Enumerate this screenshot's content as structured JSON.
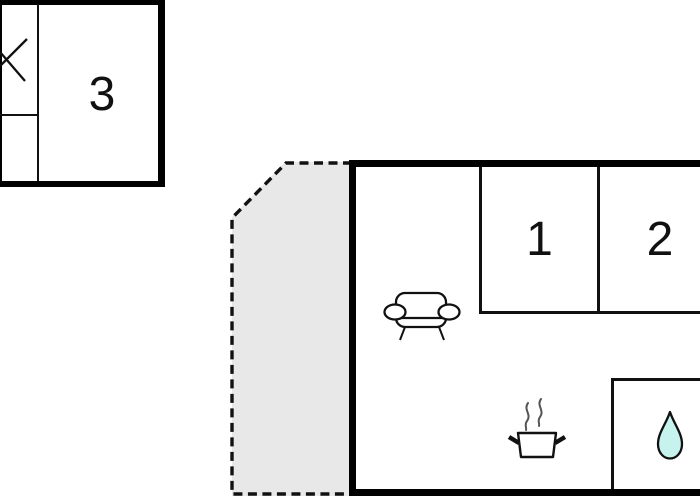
{
  "title": "Holiday home floor plan",
  "colors": {
    "background": "#ffffff",
    "wall": "#000000",
    "terrace_fill": "#e8e8e8",
    "water_drop_fill": "#c7f3ef",
    "steam_gray": "#555555"
  },
  "floorplan": {
    "annex": {
      "label": "3",
      "symbol": "window-cross-icon"
    },
    "main_building": {
      "room_1": {
        "label": "1"
      },
      "room_2": {
        "label": "2"
      },
      "living_area": {
        "icon": "sofa-icon"
      },
      "kitchen": {
        "icon": "cooking-pot-icon"
      },
      "bathroom": {
        "icon": "water-drop-icon"
      }
    },
    "terrace": {
      "outline": "dashed"
    }
  }
}
